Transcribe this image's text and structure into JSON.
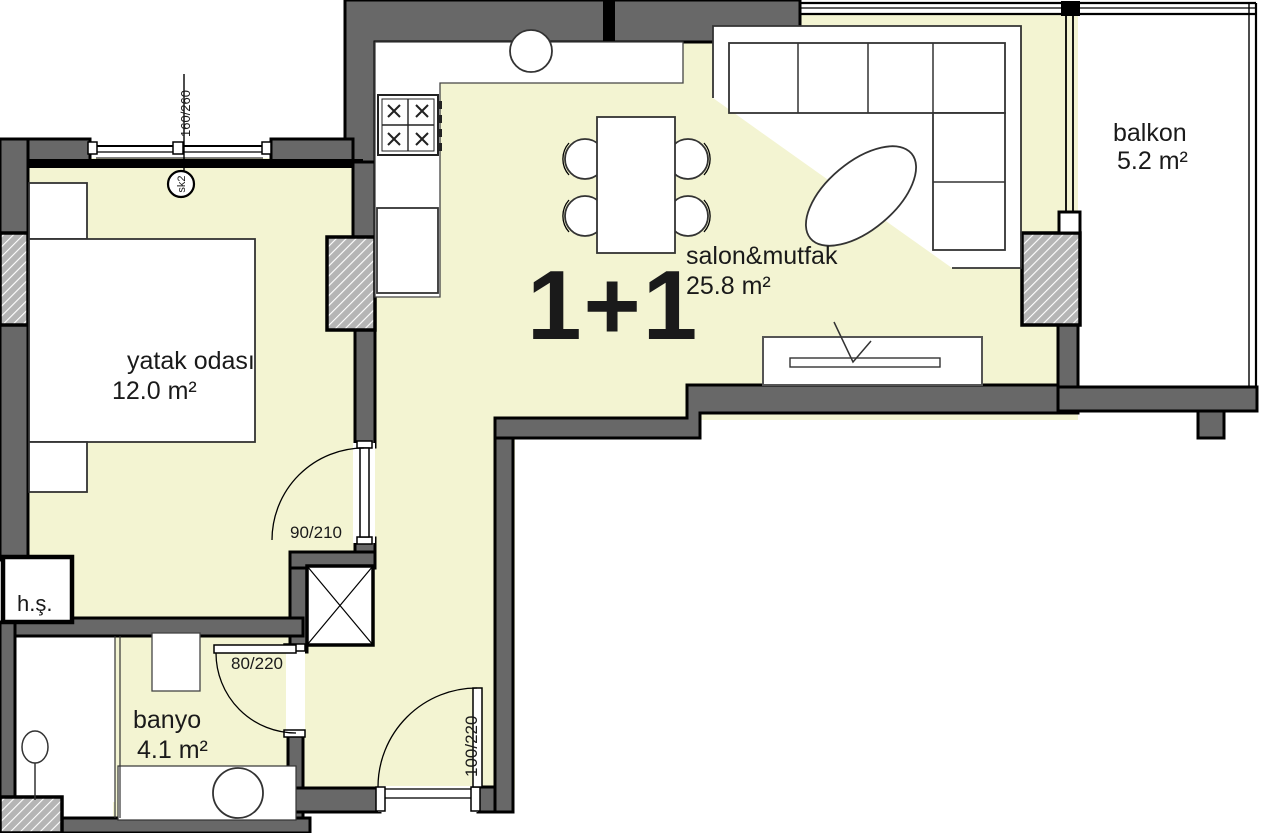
{
  "title": "1+1 apartment floor plan",
  "plan_type_label": "1+1",
  "rooms": [
    {
      "name": "yatak odası",
      "area": "12.0 m²"
    },
    {
      "name": "salon&mutfak",
      "area": "25.8 m²"
    },
    {
      "name": "balkon",
      "area": "5.2 m²"
    },
    {
      "name": "banyo",
      "area": "4.1 m²"
    },
    {
      "name": "h.ş."
    }
  ],
  "doors": [
    {
      "size": "90/210"
    },
    {
      "size": "80/220"
    },
    {
      "size": "100/220"
    }
  ],
  "window": {
    "size": "160/260",
    "tag": "sk2"
  },
  "colors": {
    "floor": "#f3f4d2",
    "wall": "#686868",
    "outline": "#000000",
    "column_hatch": "#b5b5b5"
  }
}
